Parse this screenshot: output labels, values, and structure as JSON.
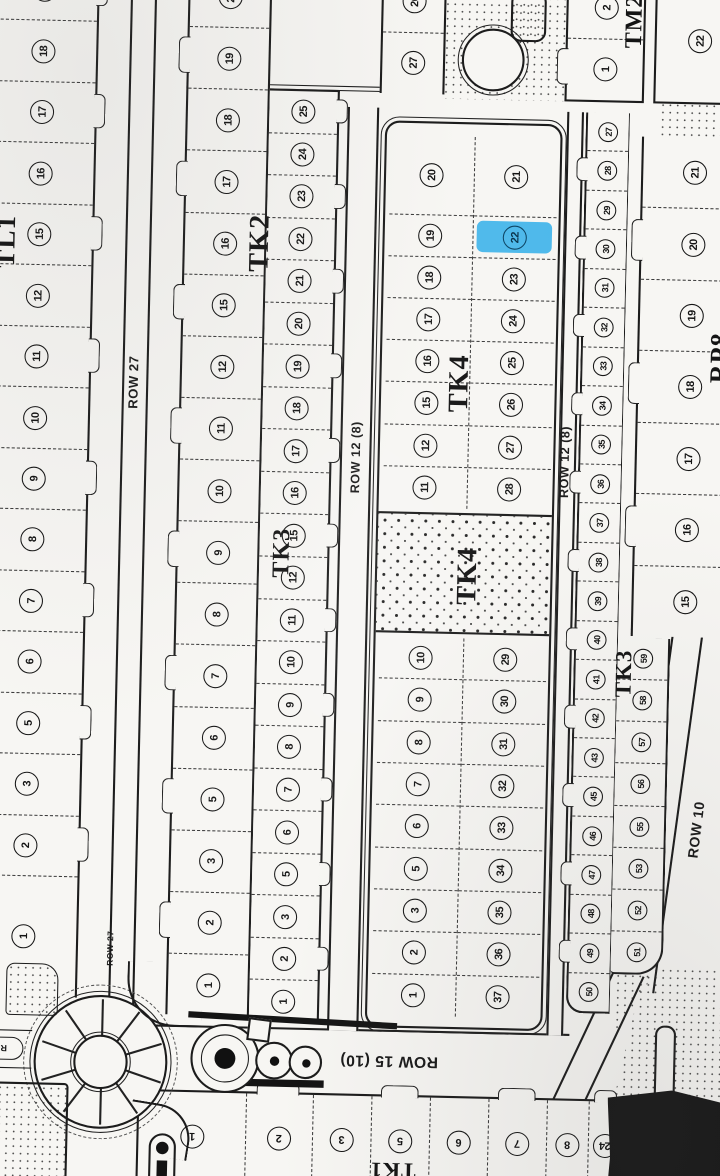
{
  "map_title": "Subdivision plat scan",
  "highlight_color": "#3fb3ea",
  "selected_lot": "22",
  "blocks": {
    "tl1": {
      "label": "TL1",
      "lots": [
        "19",
        "18",
        "17",
        "16",
        "15",
        "12",
        "11",
        "10",
        "9",
        "8",
        "7",
        "6",
        "5",
        "3",
        "2",
        "1"
      ]
    },
    "tk2": {
      "label": "TK2",
      "lots": [
        "20",
        "19",
        "18",
        "17",
        "16",
        "15",
        "12",
        "11",
        "10",
        "9",
        "8",
        "7",
        "6",
        "5",
        "3",
        "2",
        "1"
      ]
    },
    "tk3_west": {
      "label": "TK3",
      "lots": [
        "25",
        "24",
        "23",
        "22",
        "21",
        "20",
        "19",
        "18",
        "17",
        "16",
        "15",
        "12",
        "11",
        "10",
        "9",
        "8",
        "7",
        "6",
        "5",
        "3",
        "2",
        "1"
      ]
    },
    "top_lots": {
      "lots": [
        "26",
        "27"
      ]
    },
    "tk4": {
      "label": "TK4",
      "reserve_label": "TK4",
      "top_left": [
        "20",
        "19",
        "18",
        "17",
        "16",
        "15",
        "12",
        "11"
      ],
      "top_right": [
        "21",
        "22",
        "23",
        "24",
        "25",
        "26",
        "27",
        "28"
      ],
      "highlighted_lot": "22",
      "bottom_left": [
        "10",
        "9",
        "8",
        "7",
        "6",
        "5",
        "3",
        "2",
        "1"
      ],
      "bottom_right": [
        "29",
        "30",
        "31",
        "32",
        "33",
        "34",
        "35",
        "36",
        "37"
      ]
    },
    "strip_east": {
      "lots": [
        "27",
        "28",
        "29",
        "30",
        "31",
        "32",
        "33",
        "34",
        "35",
        "36",
        "37",
        "38",
        "39",
        "40",
        "41",
        "42",
        "43",
        "45",
        "46",
        "47",
        "48",
        "49",
        "50"
      ]
    },
    "tk3_east": {
      "label": "TK3",
      "lots": [
        "59",
        "58",
        "57",
        "56",
        "55",
        "53",
        "52",
        "51"
      ]
    },
    "rp8": {
      "label": "RP8",
      "lots": [
        "21",
        "20",
        "19",
        "18",
        "17",
        "16",
        "15"
      ]
    },
    "tm2": {
      "label": "TM2",
      "lots": [
        "2",
        "1"
      ],
      "side_lots": [
        "22"
      ]
    },
    "tk1": {
      "label": "TK1",
      "lots": [
        "1",
        "2",
        "3",
        "5",
        "6",
        "7",
        "8",
        "24"
      ]
    }
  },
  "roads": {
    "row27": "ROW 27",
    "row27_small": "ROW 27",
    "row12_left": "ROW 12 (8)",
    "row12_right": "ROW 12 (8)",
    "row10": "ROW 10",
    "row15": "ROW 15 (10)",
    "row2": "ROW 2"
  }
}
